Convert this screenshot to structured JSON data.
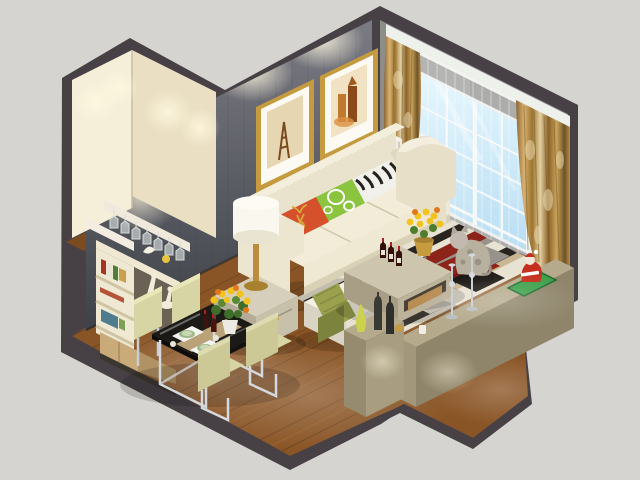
{
  "scene": {
    "type": "isometric-3d-cutaway-render",
    "subject": "small living room and dining room interior, dollhouse view",
    "objects": [
      "cream cutaway walls with spotlights",
      "gray accent wall with two gold-framed prints (eiffel tower, castle)",
      "window wall with blue glass, sheer curtains and gold patterned drapes",
      "cream three-seat sofa with zebra, green-ring and orange deer pillows",
      "white drum table lamp on side table",
      "arc floor lamp with gray dome shade",
      "greige coffee table with wine bottles and yellow flowers",
      "geometric rug in ivory, black, red and gray",
      "ottoman with olive green throw",
      "bar wall with hanging stemware, shelves, books and figurines",
      "glass dining table with chrome legs, four pale chairs, bouquet and place settings",
      "low khaki pony walls with candlesticks, vases, green mat and santa figurine",
      "cat figurine",
      "white radiator",
      "dark wood plank flooring"
    ]
  },
  "colors": {
    "background": "#d6d4d1",
    "outline": "#474145",
    "wood": "#8a5526",
    "woodDark": "#5e3a19",
    "grayWallTop": "#75757e",
    "grayWallBottom": "#41444b",
    "creamWallA": "#f5eed9",
    "creamWallB": "#eadfc2",
    "windowBlue": "#c4e7f9",
    "mullion": "#f2f5f5",
    "valance": "#eef0ec",
    "curtainGold": "#b98c4a",
    "curtainGoldDark": "#7c5a28",
    "curtainGoldLight": "#e3cfa0",
    "sofaCream": "#efe9d4",
    "sofaShade": "#d9d1b6",
    "pillowOrange": "#d4512b",
    "pillowGreen": "#8bc43f",
    "zebraWhite": "#f2f0ea",
    "tableGreige": "#cec5ae",
    "tableGreigeSide": "#a89d85",
    "rugIvory": "#e8e2d2",
    "rugBlack": "#29241f",
    "rugRed": "#8c241a",
    "rugGray": "#98938a",
    "rugTan": "#c9b793",
    "khakiTop": "#b5aa8c",
    "khakiFace": "#8f856b",
    "diningGlass": "#1c1a17",
    "runnerTan": "#c3a97c",
    "chrome": "#d5d9dd",
    "chairPale": "#d8d5a4",
    "flowerYellow": "#f2c21e",
    "flowerOrange": "#e07818",
    "leafGreen": "#4e7d2e",
    "wineBottle": "#331109",
    "lampWhite": "#faf7ee",
    "gold": "#c69b3f",
    "radiator": "#efede3",
    "santaRed": "#c5301e",
    "matGreen": "#3da04a",
    "catGray": "#b9b1a0",
    "blanketOlive": "#9aa04e",
    "bookRed": "#a83325",
    "bookGreen": "#4f7d3a",
    "shelfCream": "#efe8d2",
    "doorWood": "#c9ab7a",
    "glowWarm": "#fff6dd"
  }
}
